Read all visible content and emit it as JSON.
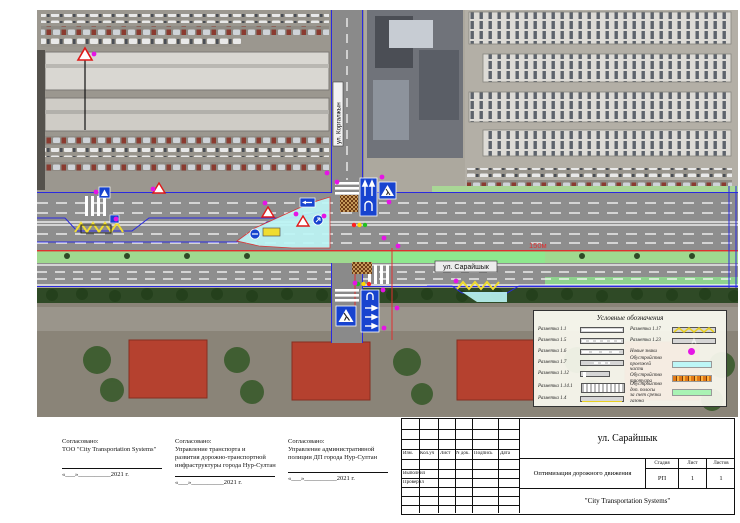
{
  "map": {
    "street_main_label": "ул. Сарайшык",
    "street_cross_label": "ул. Коргалжын",
    "distance_label": "150м"
  },
  "legend": {
    "title": "Условные обозначения",
    "left_items": [
      {
        "label": "Разметка 1.1"
      },
      {
        "label": "Разметка 1.5"
      },
      {
        "label": "Разметка 1.6"
      },
      {
        "label": "Разметка 1.7"
      },
      {
        "label": "Разметка 1.12"
      },
      {
        "label": "Разметка 1.14.1"
      },
      {
        "label": "Разметка 1.4"
      }
    ],
    "right_items": [
      {
        "label": "Разметка 1.17"
      },
      {
        "label": "Разметка 1.23"
      },
      {
        "label": "Новые знаки"
      },
      {
        "label": "Обустройство проезжей",
        "label2": "части"
      },
      {
        "label": "Обустройство тротуара"
      },
      {
        "label": "Обустройство доп. полосы",
        "label2": "за счет срезки газона"
      }
    ]
  },
  "approvals": [
    {
      "heading": "Согласовано:",
      "org_lines": [
        "ТОО \"City Transportation Systems\""
      ],
      "date": "«___»__________2021 г."
    },
    {
      "heading": "Согласовано:",
      "org_lines": [
        "Управление транспорта и",
        "развития дорожно-транспортной",
        "инфраструктуры города Нур-Султан"
      ],
      "date": "«___»__________2021 г."
    },
    {
      "heading": "Согласовано:",
      "org_lines": [
        "Управление административной",
        "полиции ДП города Нур-Султан"
      ],
      "date": "«___»__________2021 г."
    }
  ],
  "title_block": {
    "title": "ул. Сарайшык",
    "subtitle": "Оптимизация дорожного движения",
    "company": "\"City Transportation Systems\"",
    "stage_label": "Стадия",
    "sheet_label": "Лист",
    "sheets_label": "Листов",
    "stage_value": "РП",
    "sheet_value": "1",
    "sheets_value": "1",
    "columns": [
      "Изм.",
      "Кол.уч",
      "Лист",
      "N док.",
      "Подпись",
      "Дата"
    ],
    "rows": [
      "Выполнил",
      "Проверил"
    ]
  },
  "colors": {
    "sign_blue": "#1743cf",
    "new_sign_magenta": "#e514e5",
    "roadway_cyan": "#bdf6f6",
    "sidewalk_orange": "#e07818",
    "added_lane_green": "#8ee88e",
    "marking_yellow": "#f0dc30",
    "red_line": "#e03030"
  }
}
